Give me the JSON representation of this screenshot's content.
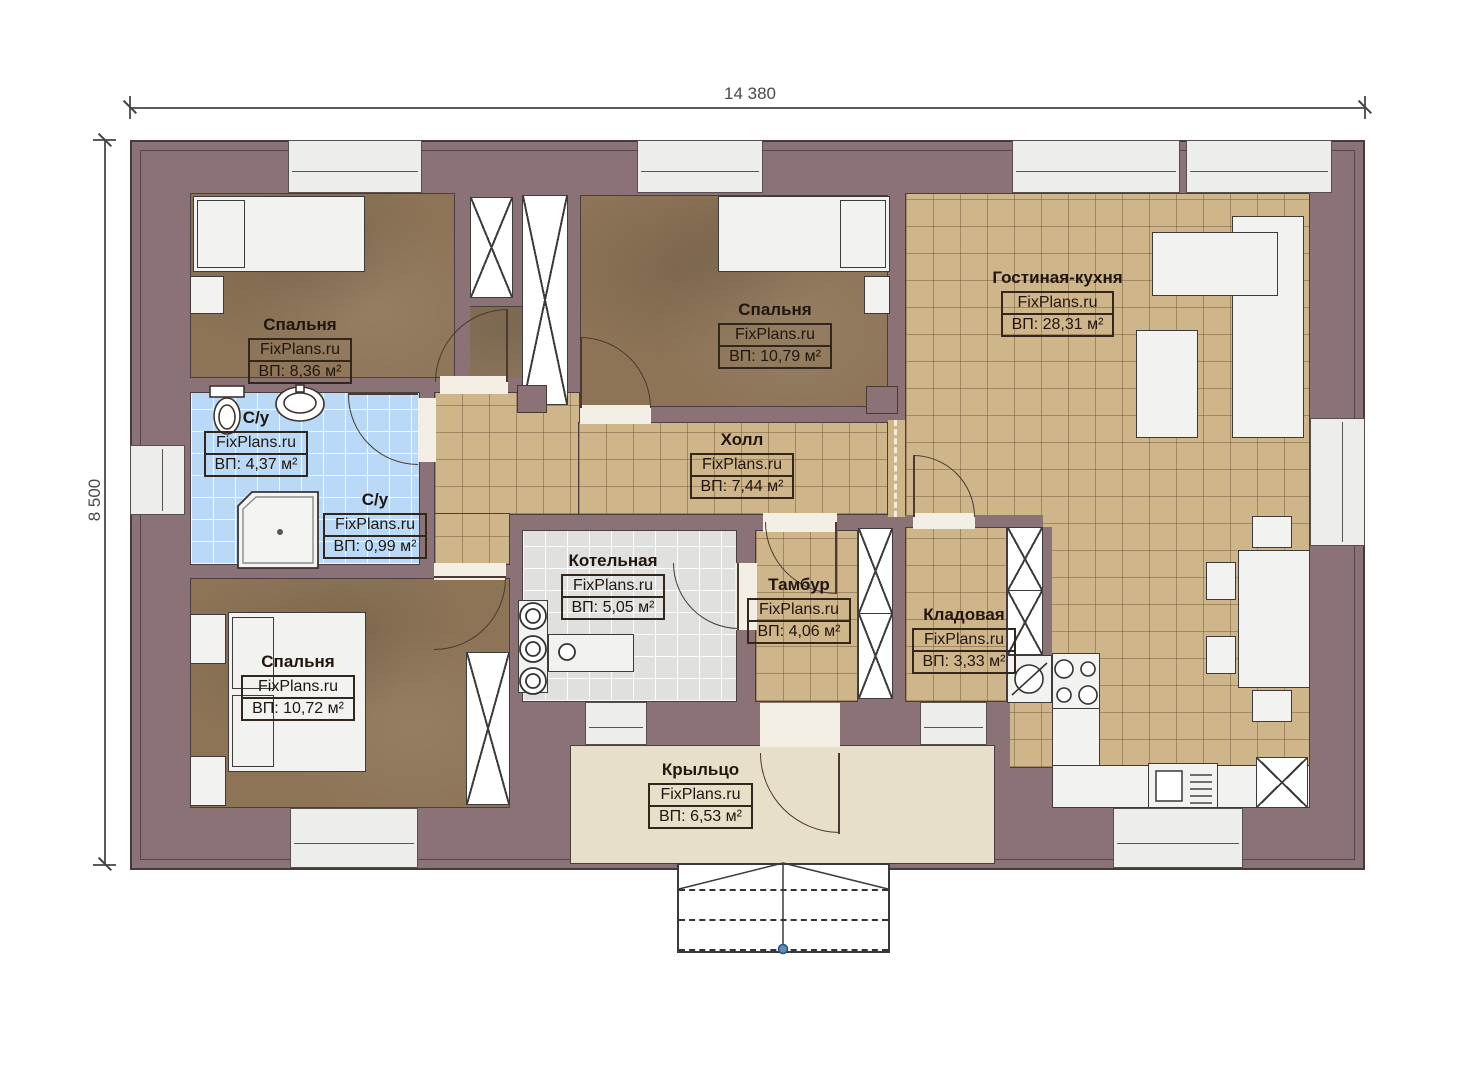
{
  "watermark": "FixPlans.ru",
  "dimensions": {
    "width": "14 380",
    "height": "8 500"
  },
  "rooms": [
    {
      "id": "bedroom-1",
      "name": "Спальня",
      "area": "ВП: 8,36 м²"
    },
    {
      "id": "bedroom-2",
      "name": "Спальня",
      "area": "ВП: 10,79 м²"
    },
    {
      "id": "living-kitchen",
      "name": "Гостиная-кухня",
      "area": "ВП: 28,31 м²"
    },
    {
      "id": "bathroom-main",
      "name": "С/у",
      "area": "ВП: 4,37 м²"
    },
    {
      "id": "bathroom-small",
      "name": "С/у",
      "area": "ВП: 0,99 м²"
    },
    {
      "id": "hall",
      "name": "Холл",
      "area": "ВП: 7,44 м²"
    },
    {
      "id": "boiler-room",
      "name": "Котельная",
      "area": "ВП: 5,05 м²"
    },
    {
      "id": "vestibule",
      "name": "Тамбур",
      "area": "ВП: 4,06 м²"
    },
    {
      "id": "storage",
      "name": "Кладовая",
      "area": "ВП: 3,33 м²"
    },
    {
      "id": "bedroom-3",
      "name": "Спальня",
      "area": "ВП: 10,72 м²"
    },
    {
      "id": "porch",
      "name": "Крыльцо",
      "area": "ВП: 6,53 м²"
    }
  ],
  "colors": {
    "wall": "#8b7277",
    "wood_floor": "#8d7457",
    "tile_floor": "#cfb58a",
    "bath_tile": "#b9d9f6",
    "boiler_tile": "#e0e0de",
    "porch_floor": "#e8dfc9",
    "line": "#4a3a31",
    "step_dot": "#5b8ec4"
  }
}
